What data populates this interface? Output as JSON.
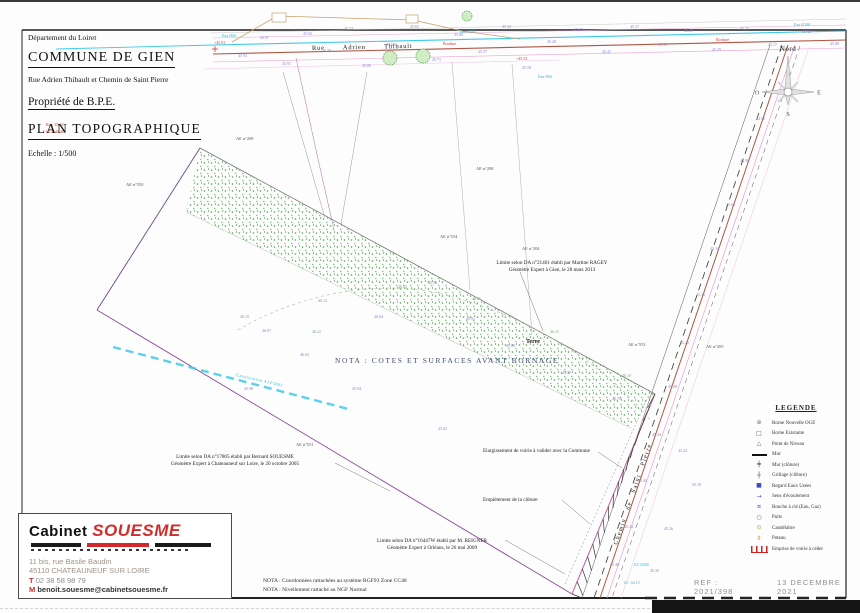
{
  "document": {
    "department": "Département du Loiret",
    "commune": "COMMUNE DE GIEN",
    "address": "Rue Adrien Thibault et Chemin de Saint Pierre",
    "owner": "Propriété de B.P.E.",
    "doc_title": "PLAN TOPOGRAPHIQUE",
    "scale": "Echelle : 1/500"
  },
  "north_arrow": {
    "north": "Nord",
    "south": "S",
    "east": "E",
    "west": "O"
  },
  "map": {
    "street_name": "Rue Adrien Thibault",
    "road_name": "Chemin de Saint Pierre",
    "nota_center": "NOTA : COTES ET SURFACES AVANT BORNAGE",
    "terre": "Terre",
    "water_main_label": "Canalisation AEP Ø63",
    "labels": {
      "elargissement": "Elargissement de voirie à valider avec la Commune",
      "empietement": "Empiétement de la clôture"
    },
    "limits": {
      "ragey": [
        "Limite selon DA n°21461 établi par Martine RAGEY",
        "Géomètre Expert à Gien, le 28 mars 2013"
      ],
      "souesme": [
        "Limite selon DA n°17805 établi par Bernard SOUESME",
        "Géomètre Expert à Chateauneuf sur Loire, le 20 octobre 2005"
      ],
      "reigner": [
        "Limite selon DA n°16447W établi par M. REIGNER",
        "Géomètre Expert à Orléans, le 26 mai 2009"
      ]
    },
    "parcel_ids": [
      [
        126,
        186,
        "AE n°550"
      ],
      [
        236,
        140,
        "AE n°209"
      ],
      [
        440,
        238,
        "AE n°554"
      ],
      [
        522,
        250,
        "AE n°204"
      ],
      [
        628,
        346,
        "AE n°553"
      ],
      [
        706,
        348,
        "AE n°205"
      ],
      [
        296,
        446,
        "AE n°551"
      ],
      [
        476,
        170,
        "AE n°208"
      ]
    ],
    "spots": [
      [
        238,
        57,
        "45.93",
        "v"
      ],
      [
        260,
        39,
        "45.87",
        "v"
      ],
      [
        282,
        65,
        "45.91",
        "v"
      ],
      [
        303,
        35,
        "45.82",
        "v"
      ],
      [
        322,
        52,
        "45.78",
        "v"
      ],
      [
        344,
        30,
        "45.74",
        "v"
      ],
      [
        362,
        67,
        "45.80",
        "v"
      ],
      [
        386,
        46,
        "45.69",
        "v"
      ],
      [
        410,
        28,
        "45.65",
        "v"
      ],
      [
        432,
        61,
        "45.71",
        "v"
      ],
      [
        454,
        36,
        "45.60",
        "v"
      ],
      [
        478,
        53,
        "45.57",
        "v"
      ],
      [
        502,
        28,
        "45.52",
        "v"
      ],
      [
        522,
        69,
        "45.58",
        "v"
      ],
      [
        547,
        43,
        "45.49",
        "v"
      ],
      [
        574,
        31,
        "45.45",
        "v"
      ],
      [
        602,
        53,
        "45.41",
        "v"
      ],
      [
        630,
        28,
        "45.37",
        "v"
      ],
      [
        658,
        46,
        "45.33",
        "v"
      ],
      [
        684,
        32,
        "45.29",
        "v"
      ],
      [
        712,
        51,
        "45.25",
        "v"
      ],
      [
        740,
        30,
        "45.21",
        "v"
      ],
      [
        768,
        46,
        "45.17",
        "v"
      ],
      [
        802,
        33,
        "45.12",
        "v"
      ],
      [
        830,
        45,
        "45.08",
        "v"
      ],
      [
        262,
        332,
        "46.07",
        "v"
      ],
      [
        318,
        302,
        "46.12",
        "v"
      ],
      [
        374,
        318,
        "46.04",
        "v"
      ],
      [
        428,
        284,
        "45.96",
        "v"
      ],
      [
        466,
        320,
        "45.91",
        "v"
      ],
      [
        506,
        347,
        "45.85",
        "v"
      ],
      [
        562,
        374,
        "45.78",
        "v"
      ],
      [
        612,
        400,
        "45.70",
        "v"
      ],
      [
        438,
        430,
        "45.82",
        "v"
      ],
      [
        352,
        390,
        "45.94",
        "v"
      ],
      [
        300,
        356,
        "46.02",
        "v"
      ],
      [
        244,
        390,
        "45.98",
        "v"
      ],
      [
        240,
        318,
        "46.18",
        "g"
      ],
      [
        312,
        333,
        "46.22",
        "g"
      ],
      [
        398,
        288,
        "46.25",
        "g"
      ],
      [
        472,
        300,
        "46.21",
        "g"
      ],
      [
        550,
        333,
        "46.15",
        "g"
      ],
      [
        622,
        377,
        "46.10",
        "g"
      ],
      [
        756,
        120,
        "44.92",
        "v"
      ],
      [
        740,
        162,
        "44.98",
        "v"
      ],
      [
        726,
        206,
        "45.04",
        "v"
      ],
      [
        710,
        250,
        "45.10",
        "v"
      ],
      [
        696,
        296,
        "45.16",
        "v"
      ],
      [
        680,
        344,
        "45.22",
        "v"
      ],
      [
        668,
        388,
        "45.28",
        "v"
      ],
      [
        652,
        436,
        "45.34",
        "v"
      ],
      [
        678,
        452,
        "45.24",
        "v"
      ],
      [
        638,
        482,
        "45.40",
        "v"
      ],
      [
        692,
        486,
        "45.18",
        "v"
      ],
      [
        624,
        528,
        "45.44",
        "v"
      ],
      [
        664,
        530,
        "45.26",
        "v"
      ],
      [
        610,
        566,
        "45.48",
        "v"
      ],
      [
        650,
        572,
        "45.30",
        "v"
      ],
      [
        222,
        37,
        "Eau Ø60",
        "c"
      ],
      [
        460,
        33,
        "Eau Ø100",
        "c"
      ],
      [
        794,
        26,
        "Eau Ø100",
        "c"
      ],
      [
        634,
        566,
        "EU Ø200",
        "c"
      ],
      [
        624,
        584,
        "fil : 44.10",
        "c"
      ],
      [
        538,
        78,
        "Eau Ø60",
        "c"
      ],
      [
        214,
        44,
        "+45.91",
        "r"
      ],
      [
        516,
        60,
        "+45.33",
        "r"
      ],
      [
        443,
        45,
        "Bordure",
        "r"
      ],
      [
        716,
        41,
        "Bordure",
        "r"
      ],
      [
        46,
        126,
        "Rep. 45.62",
        "r"
      ],
      [
        46,
        133,
        "NGF 45.48",
        "r"
      ]
    ]
  },
  "legend": {
    "title": "LEGENDE",
    "items": [
      {
        "icon": "borne-oge-icon",
        "label": "Borne Nouvelle OGE"
      },
      {
        "icon": "borne-existante-icon",
        "label": "Borne Existante"
      },
      {
        "icon": "point-niveau-icon",
        "label": "Point de Niveau"
      },
      {
        "icon": "mur-icon",
        "label": "Mur"
      },
      {
        "icon": "mur-cloture-icon",
        "label": "Mur (clôture)"
      },
      {
        "icon": "grillage-icon",
        "label": "Grillage (clôture)"
      },
      {
        "icon": "regard-eu-icon",
        "label": "Regard Eaux Usées"
      },
      {
        "icon": "sens-ecoulement-icon",
        "label": "Sens d'écoulement"
      },
      {
        "icon": "bouche-cle-icon",
        "label": "Bouche à clé (Eau, Gaz)"
      },
      {
        "icon": "puits-icon",
        "label": "Puits"
      },
      {
        "icon": "candelabre-icon",
        "label": "Candélabre"
      },
      {
        "icon": "poteau-icon",
        "label": "Poteau"
      },
      {
        "icon": "voirie-icon",
        "label": "Emprise de voirie à céder"
      }
    ]
  },
  "footer": {
    "notes": [
      "NOTA : Coordonnées rattachées au système RGF93 Zone CC48",
      "NOTA : Nivellement rattaché au NGF Normal"
    ],
    "ref": "REF : 2021/398",
    "date": "13 DECEMBRE 2021"
  },
  "cabinet": {
    "name1": "Cabinet",
    "name2": "SOUESME",
    "address1": "11 bis, rue Basile Baudin",
    "address2": "45110 CHATEAUNEUF SUR LOIRE",
    "phone_prefix": "T",
    "phone": "02 38 58 98 79",
    "mail_prefix": "M",
    "mail": "benoit.souesme@cabinetsouesme.fr"
  },
  "colors": {
    "accent_red": "#d42a2a",
    "cyan": "#3ec9e7",
    "violet": "#8a7fd4",
    "parcel": "#8a4a9a",
    "road_red": "#b05545",
    "pink": "#e9a3cf",
    "green_dots": "#3a9a3a",
    "tan": "#c8a06a"
  }
}
